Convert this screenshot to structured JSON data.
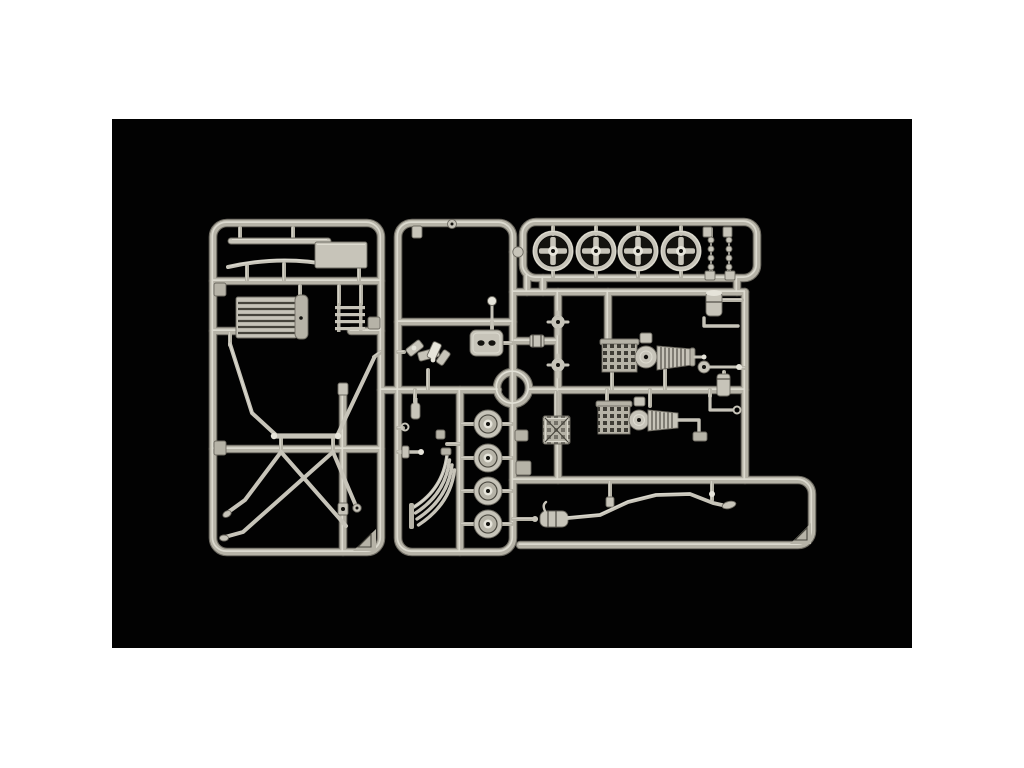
{
  "scene": {
    "subject": "model-kit-sprue-photo",
    "description": "Product photograph of a light grey injection-moulded model kit sprue (parts tree) laid on a black background with a white page border",
    "background": "black rectangle centered on white page",
    "text_visible": ""
  },
  "colors": {
    "page_bg": "#ffffff",
    "photo_bg": "#020202",
    "plastic_base": "#b6b3a7",
    "plastic_mid": "#c7c4b9",
    "plastic_light": "#e6e4da",
    "plastic_outline": "#6e6b62",
    "groove": "#46443c",
    "hole": "#14130f"
  },
  "components": {
    "frames": [
      "left-frame",
      "center-frame",
      "wheel-frame",
      "right-frame",
      "bottom-frame"
    ],
    "left_frame_parts": [
      "leaf-spring-bar",
      "curved-strip",
      "flat-plate",
      "radiator",
      "ladder-bracket",
      "chassis-tubes-upper",
      "chassis-tubes-lower",
      "corner-gusset"
    ],
    "center_frame_parts": [
      "pedal-cluster",
      "gear-lever",
      "valve-cover",
      "small-flask",
      "hook-ring",
      "tie-bar",
      "exhaust-manifold",
      "brake-drum",
      "runner-ring"
    ],
    "wheel_frame_parts": [
      "wire-wheel",
      "link-chain",
      "chain-clip",
      "knob-connector"
    ],
    "right_frame_parts": [
      "hub-joint",
      "spool",
      "engine-assembly-upper",
      "engine-assembly-lower",
      "grid-plate",
      "oil-cylinder",
      "bracket-rod",
      "tie-rod",
      "canister",
      "crank-rod"
    ],
    "bottom_frame_parts": [
      "muffler",
      "exhaust-pipe",
      "corner-gusset"
    ],
    "counts": {
      "wire_wheels": 4,
      "brake_drums": 4,
      "link_chains": 2,
      "engine_assemblies": 2
    }
  }
}
